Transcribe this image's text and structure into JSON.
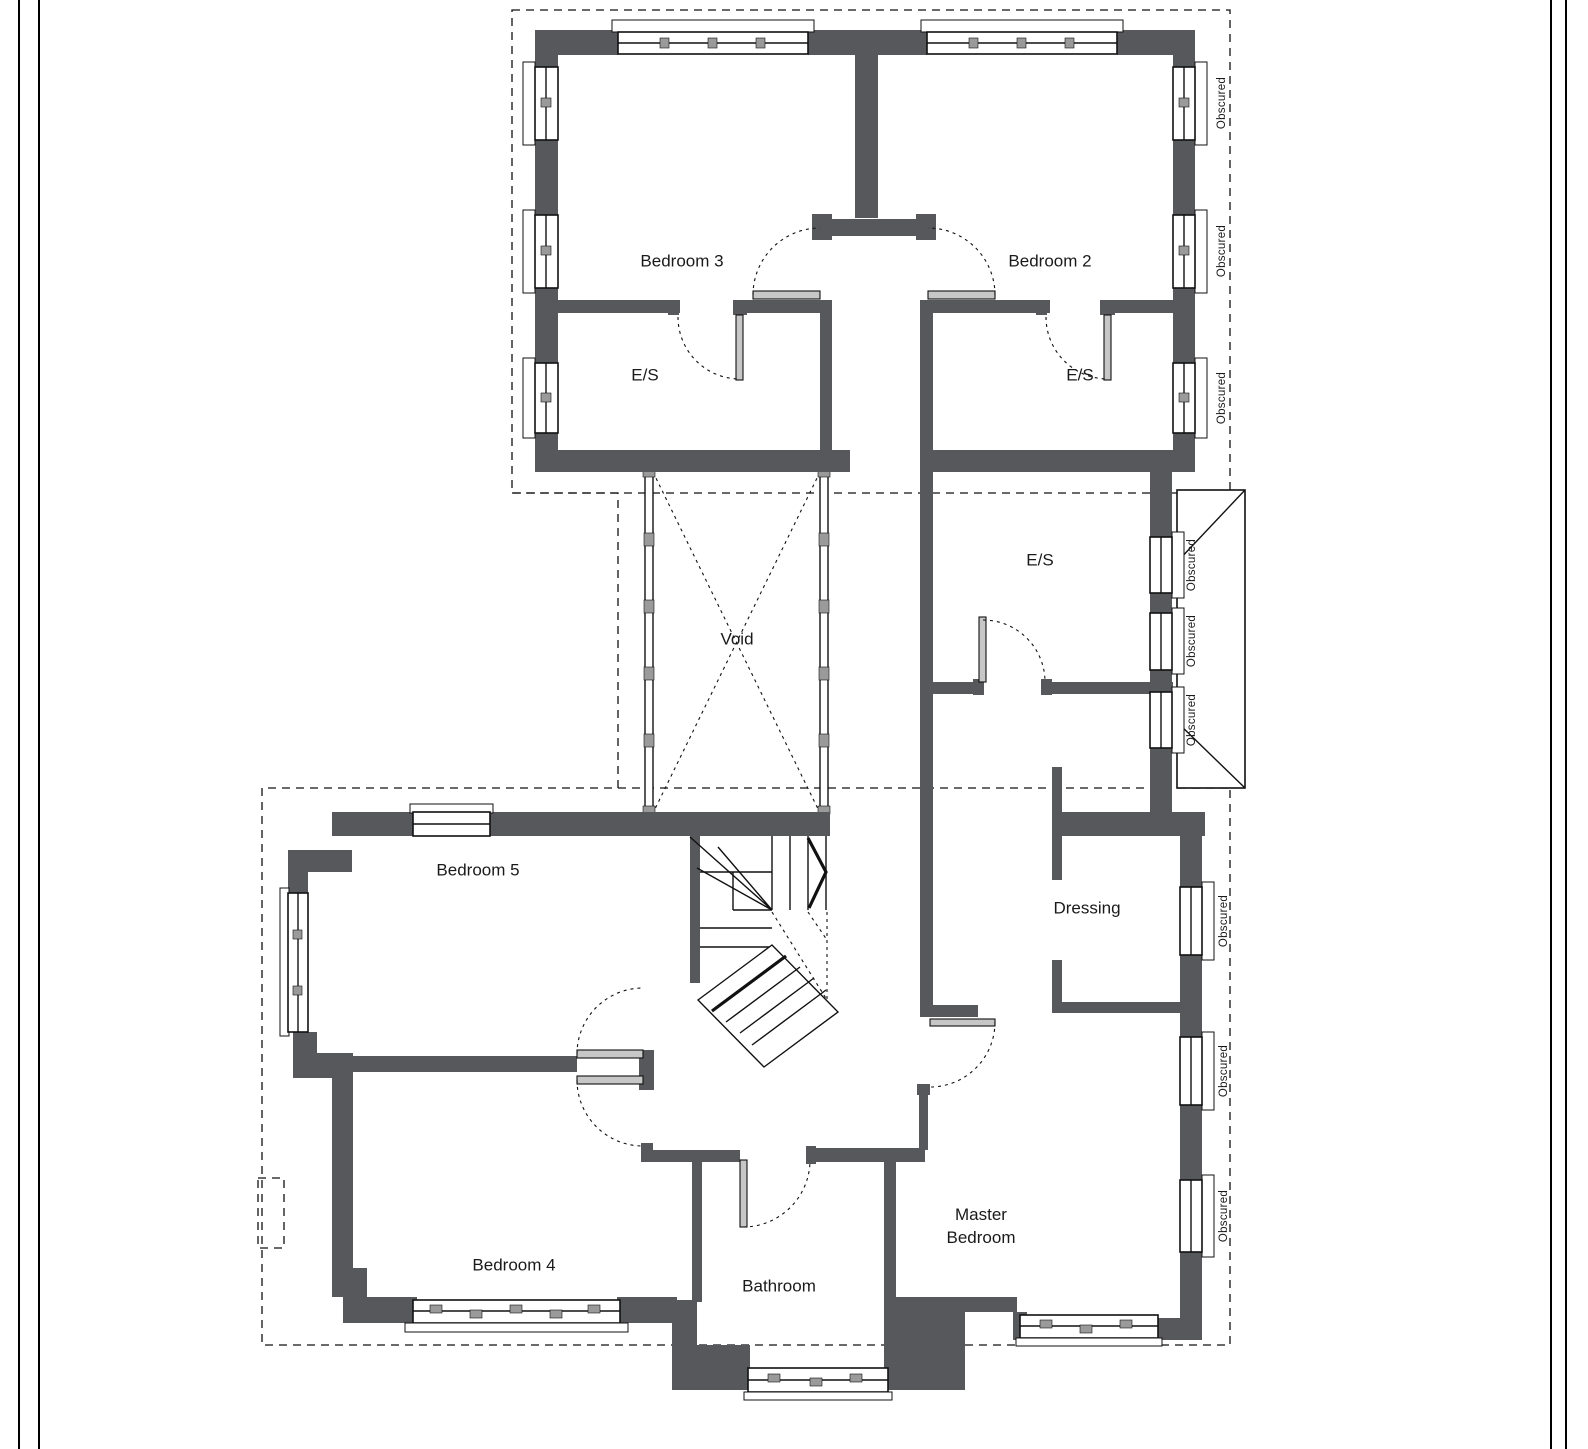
{
  "plan": {
    "wall_color": "#57585b",
    "door_color": "#c7c7c7",
    "line_color": "#111111",
    "background": "#ffffff"
  },
  "rooms": [
    {
      "id": "bedroom-3",
      "label": "Bedroom 3"
    },
    {
      "id": "bedroom-2",
      "label": "Bedroom 2"
    },
    {
      "id": "ensuite-left",
      "label": "E/S"
    },
    {
      "id": "ensuite-right",
      "label": "E/S"
    },
    {
      "id": "ensuite-middle",
      "label": "E/S"
    },
    {
      "id": "void",
      "label": "Void"
    },
    {
      "id": "bedroom-5",
      "label": "Bedroom 5"
    },
    {
      "id": "dressing",
      "label": "Dressing"
    },
    {
      "id": "bedroom-4",
      "label": "Bedroom 4"
    },
    {
      "id": "bathroom",
      "label": "Bathroom"
    },
    {
      "id": "master-bedroom",
      "label": "Master Bedroom"
    }
  ],
  "obscured": [
    {
      "label": "Obscured"
    },
    {
      "label": "Obscured"
    },
    {
      "label": "Obscured"
    },
    {
      "label": "Obscured"
    },
    {
      "label": "Obscured"
    },
    {
      "label": "Obscured"
    },
    {
      "label": "Obscured"
    },
    {
      "label": "Obscured"
    },
    {
      "label": "Obscured"
    }
  ]
}
